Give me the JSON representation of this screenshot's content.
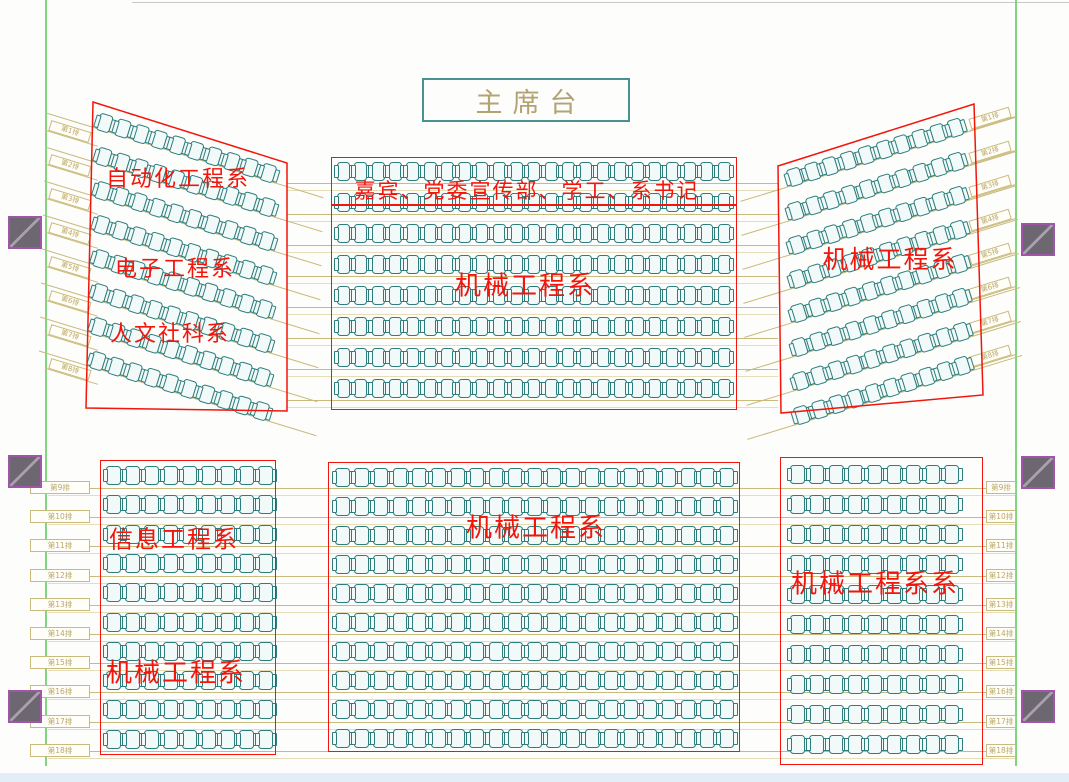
{
  "stage": {
    "label": "主席台"
  },
  "colors": {
    "red": "#f3150b",
    "seat_border": "#2c7d7c",
    "seat_fill": "#f1f9f9",
    "row_line": "#c9ba7d",
    "row_line_faint": "#e6deb8",
    "row_label_text": "#b9a86a",
    "green_border": "#7fd67f",
    "pillar_fill": "#6d6772",
    "pillar_border": "#a055a8",
    "stage_text": "#b3a274",
    "stage_border": "#4a9191",
    "top_line": "#c8c8c8",
    "bottom_strip": "#e3edf8"
  },
  "row_labels": {
    "upper": [
      "第1排",
      "第2排",
      "第3排",
      "第4排",
      "第5排",
      "第6排",
      "第7排",
      "第8排"
    ],
    "lower": [
      "第9排",
      "第10排",
      "第11排",
      "第12排",
      "第13排",
      "第14排",
      "第15排",
      "第16排",
      "第17排",
      "第18排"
    ]
  },
  "sections": [
    {
      "id": "upper-left-fan",
      "type": "fan",
      "labels": [
        {
          "text": "自动化工程系",
          "x": 178,
          "y": 177,
          "size": 22
        },
        {
          "text": "电子工程系",
          "x": 175,
          "y": 267,
          "size": 22
        },
        {
          "text": "人文社科系",
          "x": 170,
          "y": 332,
          "size": 22
        }
      ],
      "quad": [
        [
          93,
          102
        ],
        [
          287,
          163
        ],
        [
          287,
          411
        ],
        [
          86,
          408
        ]
      ],
      "rows": 8,
      "seats": 10,
      "rot": 17,
      "row_x": 98,
      "x_step": -1,
      "row_y0": 112,
      "row_pitch": 34,
      "seat_pitch": 19,
      "seat_w": 14,
      "seat_h": 18
    },
    {
      "id": "upper-center",
      "type": "grid",
      "labels": [
        {
          "text": "嘉宾、党委宣传部、学工、系书记",
          "x": 527,
          "y": 190,
          "size": 21
        },
        {
          "text": "机械工程系",
          "x": 525,
          "y": 284,
          "size": 26
        }
      ],
      "rect": [
        331,
        157,
        406,
        253
      ],
      "divider_y": 204,
      "rows": 8,
      "seats": 23,
      "row_x": 337,
      "row_y0": 162,
      "row_pitch": 31,
      "seat_pitch": 17.3,
      "seat_w": 13,
      "seat_h": 19
    },
    {
      "id": "upper-right-fan",
      "type": "fan",
      "labels": [
        {
          "text": "机械工程系",
          "x": 890,
          "y": 258,
          "size": 25
        }
      ],
      "quad": [
        [
          778,
          166
        ],
        [
          974,
          104
        ],
        [
          983,
          395
        ],
        [
          781,
          413
        ]
      ],
      "rows": 8,
      "seats": 10,
      "rot": -17,
      "row_x": 788,
      "x_step": 1,
      "row_y0": 170,
      "row_pitch": 34,
      "seat_pitch": 18.7,
      "seat_w": 14,
      "seat_h": 18
    },
    {
      "id": "lower-left",
      "type": "grid",
      "labels": [
        {
          "text": "信息工程系",
          "x": 174,
          "y": 537,
          "size": 24
        },
        {
          "text": "机械工程系",
          "x": 176,
          "y": 671,
          "size": 26
        }
      ],
      "rect": [
        100,
        460,
        176,
        295
      ],
      "rows": 10,
      "seats": 9,
      "row_x": 106,
      "row_y0": 466,
      "row_pitch": 29.3,
      "seat_pitch": 19,
      "seat_w": 15,
      "seat_h": 19
    },
    {
      "id": "lower-center",
      "type": "grid",
      "labels": [
        {
          "text": "机械工程系",
          "x": 536,
          "y": 526,
          "size": 26
        }
      ],
      "rect": [
        328,
        462,
        412,
        290
      ],
      "rows": 10,
      "seats": 21,
      "row_x": 335,
      "row_y0": 468,
      "row_pitch": 29,
      "seat_pitch": 19.2,
      "seat_w": 15,
      "seat_h": 19
    },
    {
      "id": "lower-right",
      "type": "grid",
      "labels": [
        {
          "text": "机械工程系系",
          "x": 875,
          "y": 582,
          "size": 26
        }
      ],
      "rect": [
        780,
        457,
        203,
        308
      ],
      "rows": 10,
      "seats": 9,
      "row_x": 790,
      "row_y0": 465,
      "row_pitch": 30,
      "seat_pitch": 19.3,
      "seat_w": 15,
      "seat_h": 19
    }
  ],
  "pillars": [
    {
      "x": 8,
      "y": 216
    },
    {
      "x": 8,
      "y": 455
    },
    {
      "x": 8,
      "y": 690
    },
    {
      "x": 1021,
      "y": 223
    },
    {
      "x": 1021,
      "y": 456
    },
    {
      "x": 1021,
      "y": 690
    }
  ],
  "guides": {
    "center_lines": {
      "x1": 287,
      "x2": 778,
      "y0": 183,
      "pitch": 31,
      "count": 8
    },
    "bottom_lines": {
      "x1": 48,
      "x2": 1015,
      "y0": 488,
      "pitch": 29.2,
      "count": 10
    },
    "left_stubs": {
      "x": 46,
      "y0": 118,
      "pitch": 34,
      "rot": 17,
      "len": 54
    },
    "right_stubs": {
      "x": 970,
      "y0": 118,
      "pitch": 34,
      "rot": -17,
      "len": 48
    },
    "bottom_left_labels": {
      "x": 30,
      "w": 60,
      "y0": 481,
      "pitch": 29.2
    },
    "bottom_right_labels": {
      "x": 986,
      "w": 30,
      "y0": 481,
      "pitch": 29.2
    }
  }
}
